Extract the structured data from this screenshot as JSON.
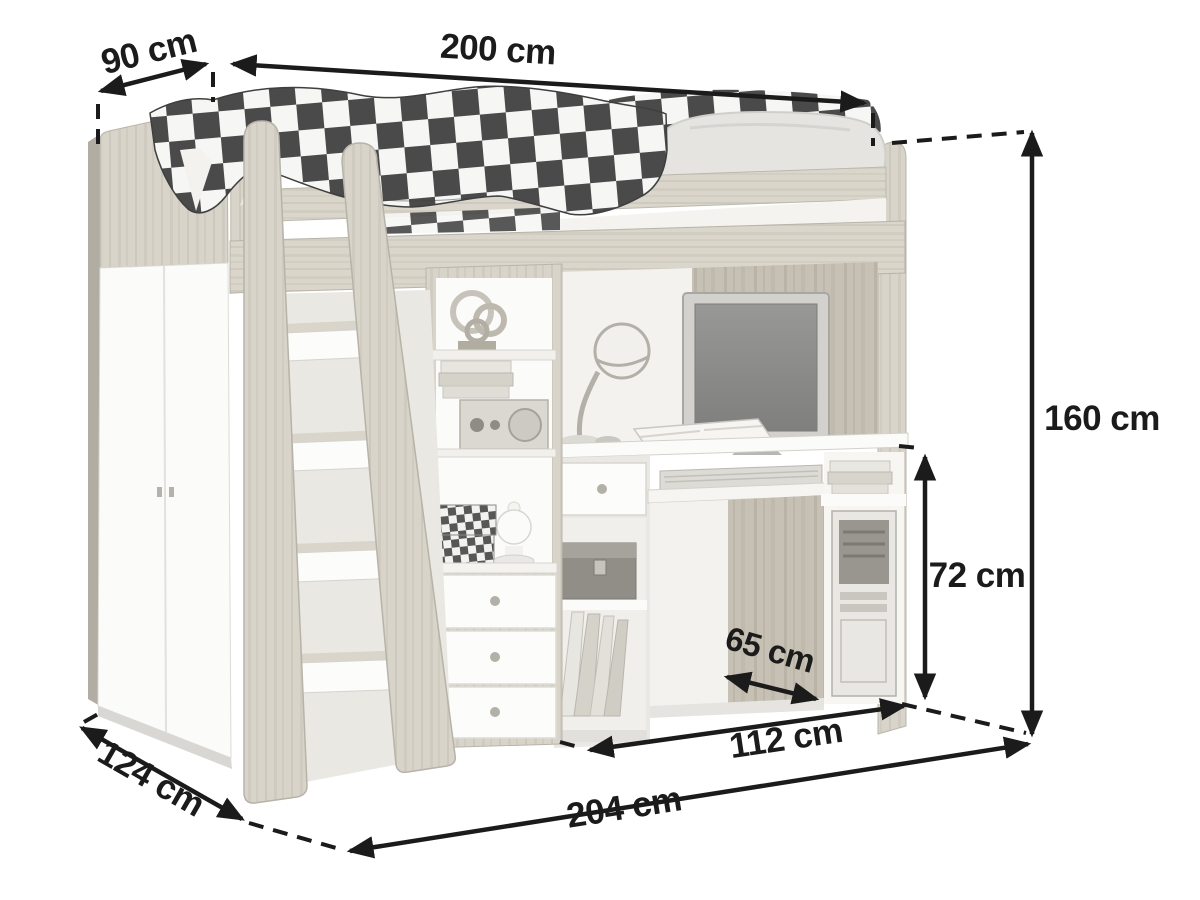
{
  "diagram": {
    "type": "furniture dimension diagram",
    "subject": "loft bed combination with wardrobe, stair shelf, drawers and desk",
    "unit": "cm",
    "dimensions": {
      "top_depth": {
        "label": "90 cm"
      },
      "top_width": {
        "label": "200 cm"
      },
      "height": {
        "label": "160 cm"
      },
      "desk_height": {
        "label": "72 cm"
      },
      "desk_depth": {
        "label": "65 cm"
      },
      "desk_width": {
        "label": "112 cm"
      },
      "base_depth": {
        "label": "124 cm"
      },
      "base_width": {
        "label": "204 cm"
      }
    },
    "colors": {
      "dimension_ink": "#1b1b1b",
      "wood_light": "#d8d4ca",
      "wood_dark": "#c6c1b4",
      "panel_white": "#fbfbfa",
      "blanket_dark": "#4a4a4a",
      "background": "#ffffff"
    }
  }
}
